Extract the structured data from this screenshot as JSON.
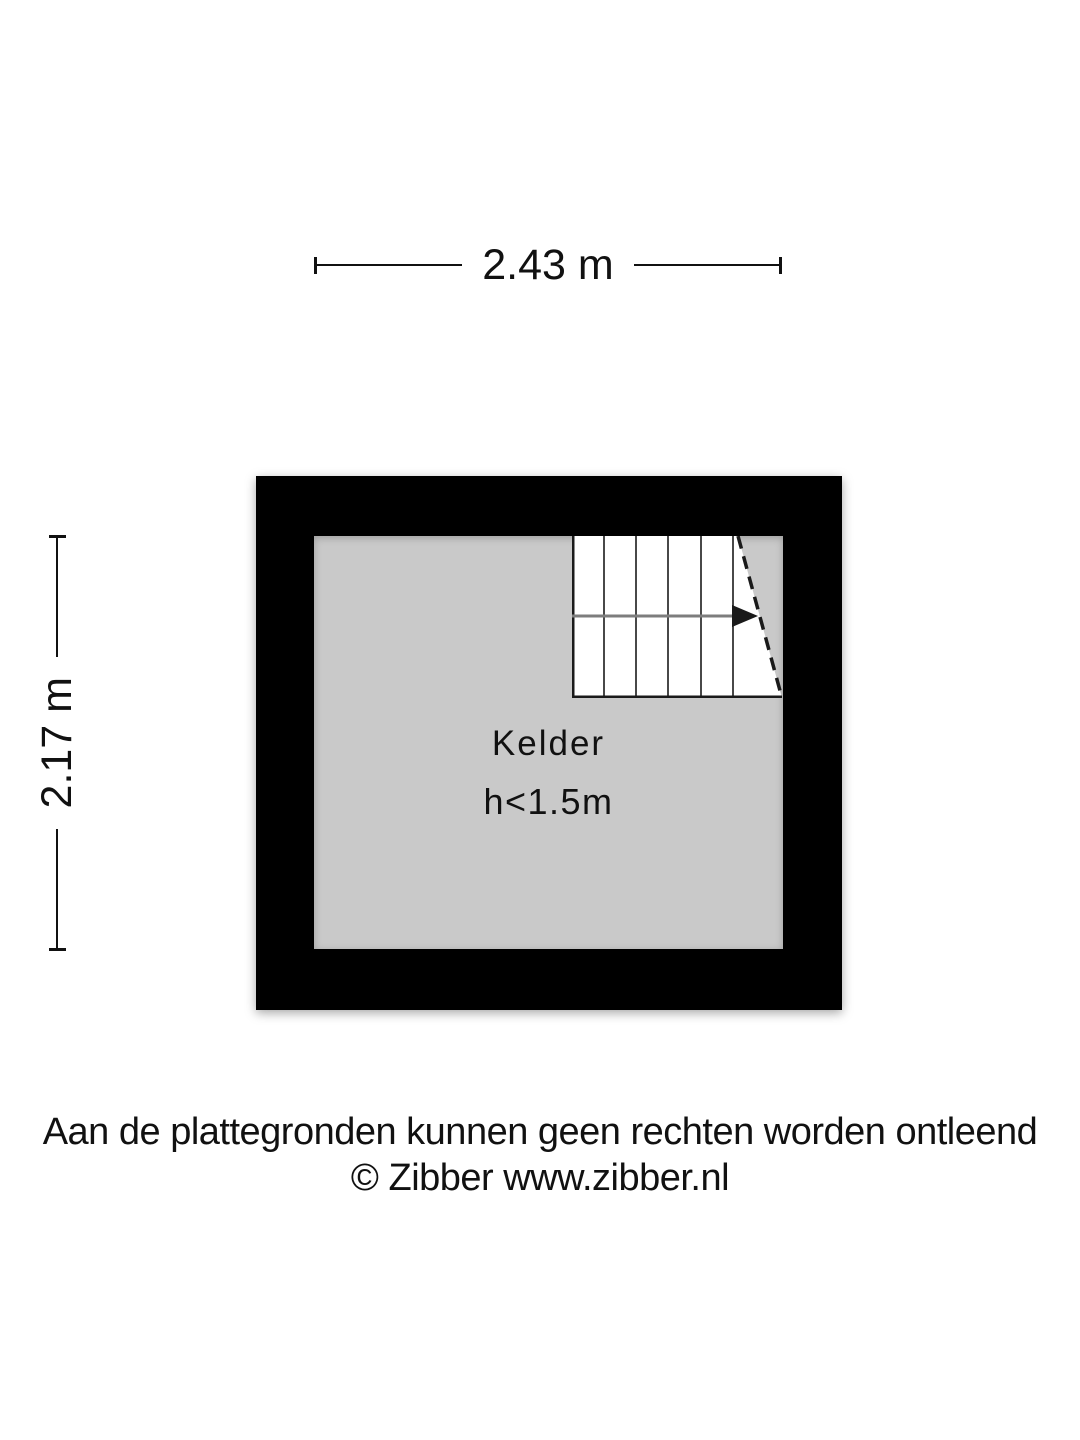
{
  "dimension_labels": {
    "width": "2.43 m",
    "height": "2.17 m"
  },
  "room": {
    "name": "Kelder",
    "height_note": "h<1.5m"
  },
  "stairs": {
    "icon": "staircase",
    "arrow_direction": "right",
    "tread_count": 6
  },
  "footer": {
    "disclaimer": "Aan de plattegronden kunnen geen rechten worden ontleend",
    "copyright": "© Zibber www.zibber.nl"
  },
  "colors": {
    "wall": "#000000",
    "floor": "#c9c9c9",
    "stairs_fill": "#ffffff",
    "stair_lines": "#1a1a1a",
    "arrow_line": "#7d7d7d",
    "text": "#111111",
    "page_bg": "#ffffff"
  }
}
